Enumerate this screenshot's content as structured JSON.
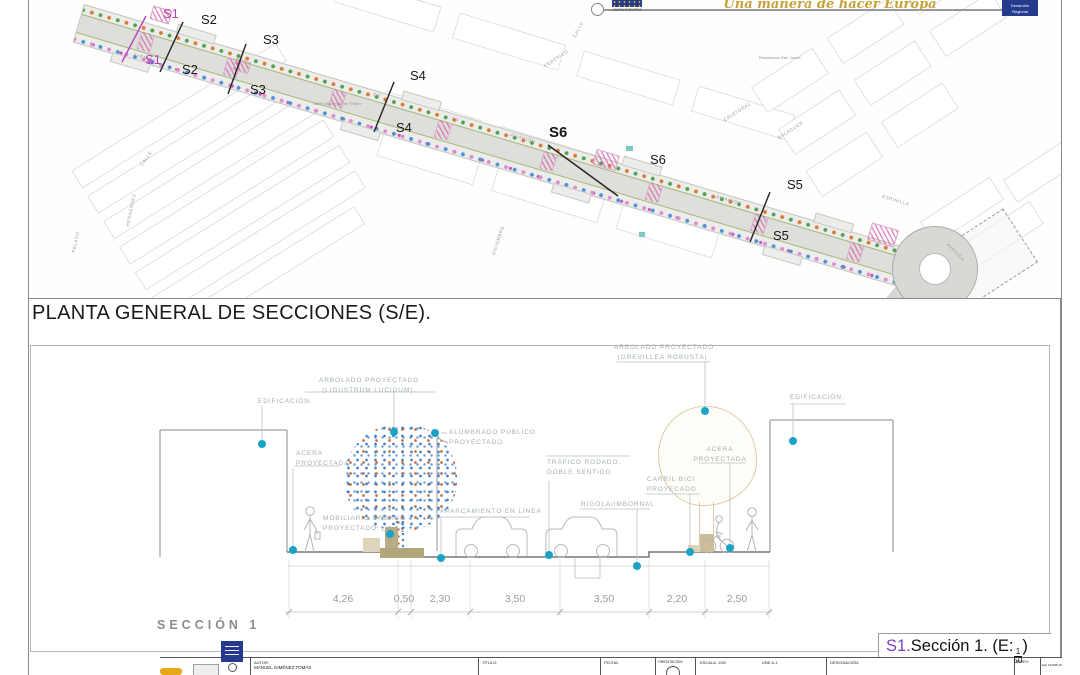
{
  "header": {
    "eu_caption": "UNIÓN EUROPEA",
    "motto": "Una manera de hacer Europa",
    "prog_line1": "Desarrollo",
    "prog_line2": "Regional"
  },
  "plan": {
    "title": "PLANTA GENERAL DE SECCIONES (S/E).",
    "markers": {
      "s1a": "S1",
      "s1b": "S1",
      "s2a": "S2",
      "s2b": "S2",
      "s3a": "S3",
      "s3b": "S3",
      "s4a": "S4",
      "s4b": "S4",
      "s6a": "S6",
      "s6b": "S6",
      "s5a": "S5",
      "s5b": "S5"
    },
    "streets": [
      {
        "t": "AVENIDA"
      },
      {
        "t": "DE"
      },
      {
        "t": "LA"
      },
      {
        "t": "AVIACIÓN"
      },
      {
        "t": "AVIACIÓN"
      },
      {
        "t": "ESPINILLA"
      },
      {
        "t": "AVENIDA"
      },
      {
        "t": "CALLE"
      },
      {
        "t": "CRISTÓBAL"
      },
      {
        "t": "BALAGUER"
      },
      {
        "t": "FEDERICO"
      },
      {
        "t": "CALLE"
      },
      {
        "t": "PELAYO"
      },
      {
        "t": "HERNÁNDEZ"
      },
      {
        "t": "DICIEMBRE"
      },
      {
        "t": "Residencia San Javier"
      },
      {
        "t": "Taller Municipal de Teatro"
      }
    ]
  },
  "section": {
    "name": "SECCIÓN 1",
    "callouts": {
      "arbolado_left": {
        "l1": "ARBOLADO PROYECTADO",
        "l2": "(LIGUSTRUM LUCIDUM)."
      },
      "edificacion_left": {
        "l1": "EDIFICACIÓN."
      },
      "alumbrado": {
        "l1": "ALUMBRADO PÚBLICO",
        "l2": "PROYECTADO."
      },
      "acera_left": {
        "l1": "ACERA",
        "l2": "PROYECTADA"
      },
      "arbolado_right": {
        "l1": "ARBOLADO PROYECTADO",
        "l2": "(GREVILLEA ROBUSTA)."
      },
      "edificacion_right": {
        "l1": "EDIFICACIÓN."
      },
      "acera_right": {
        "l1": "ACERA",
        "l2": "PROYECTADA"
      },
      "trafico": {
        "l1": "TRÁFICO RODADO.",
        "l2": "DOBLE SENTIDO"
      },
      "carril": {
        "l1": "CARRIL BICI",
        "l2": "PROYECADO"
      },
      "rigola": {
        "l1": "RIGOLA/IMBORNAL"
      },
      "aparcamiento": {
        "l1": "APARCAMIENTO EN LÍNEA"
      },
      "mobiliario": {
        "l1": "MOBILIARIO URBANO",
        "l2": "PROYECTADO."
      }
    },
    "dimensions": [
      "4,26",
      "0,50",
      "2,30",
      "3,50",
      "3,50",
      "2,20",
      "2,50"
    ],
    "caption": {
      "prefix": "S1.",
      "body": "Sección 1. (E:",
      "num": "1",
      "den": "50",
      "close": ")"
    }
  },
  "titleblock": {
    "autor_label": "AUTOR:",
    "autor_value": "MANUEL GIMÉNEZ TOMÁS",
    "titulo_label": "TÍTULO:",
    "fecha_label": "FECHA:",
    "orientacion_label": "ORIENTACIÓN:",
    "escala_label": "ESCALA: 1/50",
    "une_label": "UNE A-1",
    "designacion_label": "DESIGNACIÓN:",
    "nrev_label": "Nº/REV:",
    "exp_label": "Exp 1519/B-19"
  },
  "colors": {
    "accent_cyan": "#1ba3c6",
    "marker_magenta": "#b83fb8",
    "motto_gold": "#c9a23a",
    "eu_blue": "#243a8c",
    "caption_purple": "#7b3fc4"
  }
}
